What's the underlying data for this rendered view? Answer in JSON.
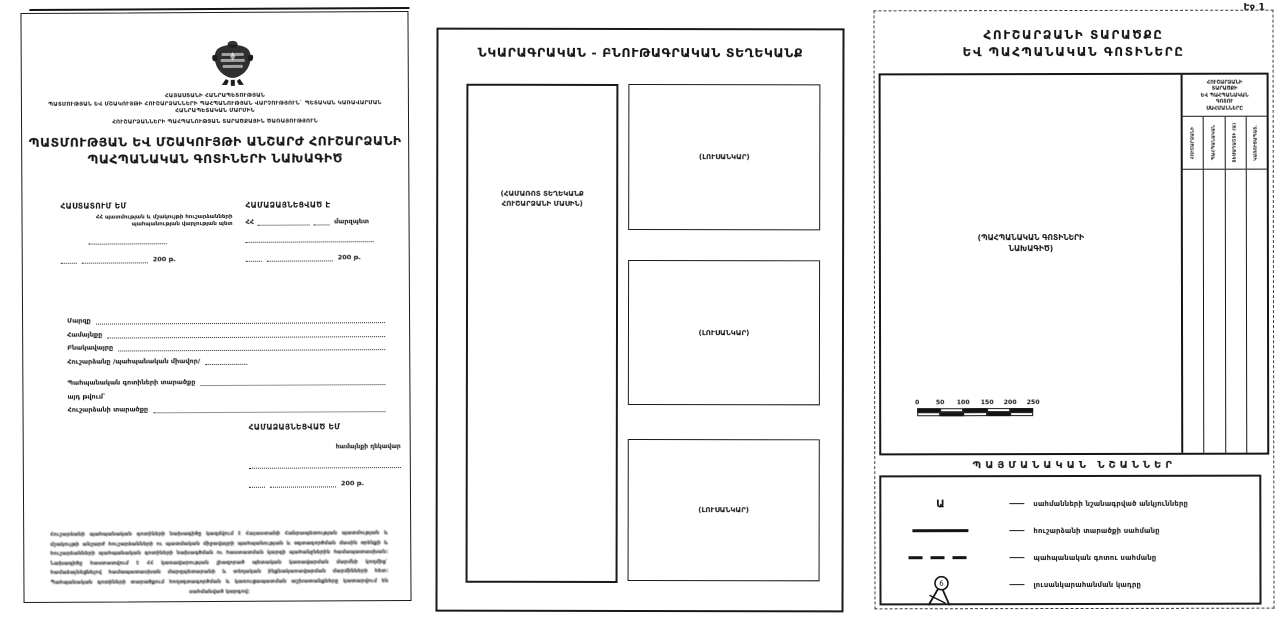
{
  "colors": {
    "ink": "#161616",
    "paper": "#ffffff"
  },
  "page_number": "Էջ 1",
  "left_page": {
    "emblem_icon": "armenia-coat-of-arms",
    "header_lines": [
      "ՀԱՅԱՍՏԱՆԻ ՀԱՆՐԱՊԵՏՈՒԹՅԱՆ",
      "ՊԱՏՄՈՒԹՅԱՆ ԵՎ ՄՇԱԿՈՒՅԹԻ ՀՈՒՇԱՐՁԱՆՆԵՐԻ ՊԱՀՊԱՆՈՒԹՅԱՆ ՎԱՐՉՈՒԹՅՈՒՆ` ՊԵՏԱԿԱՆ ԿԱՌԱՎԱՐՄԱՆ ՀԱՆՐԱՊԵՏԱԿԱՆ ՄԱՐՄԻՆ",
      "ՀՈՒՇԱՐՁԱՆՆԵՐԻ ՊԱՀՊԱՆՈՒԹՅԱՆ ՏԱՐԱԾՔԱՅԻՆ ԾԱՌԱՅՈՒԹՅՈՒՆ"
    ],
    "title_lines": [
      "ՊԱՏՄՈՒԹՅԱՆ ԵՎ ՄՇԱԿՈՒՅԹԻ ԱՆՇԱՐԺ ՀՈՒՇԱՐՁԱՆԻ",
      "ՊԱՀՊԱՆԱԿԱՆ ԳՈՏԻՆԵՐԻ ՆԱԽԱԳԻԾ"
    ],
    "approve_left": {
      "heading": "ՀԱՍՏԱՏՈՒՄ ԵՄ",
      "subtitle_lines": [
        "ՀՀ պատմության և մշակույթի հուշարձանների",
        "պահպանության վարչության պետ"
      ],
      "date_suffix": "200 թ."
    },
    "approve_right": {
      "heading": "ՀԱՄԱՁԱՅՆԵՑՎԱԾ Է",
      "prefix": "ՀՀ",
      "role": "մարզպետ",
      "date_suffix": "200 թ."
    },
    "fields": [
      {
        "label": "Մարզը"
      },
      {
        "label": "Համայնքը"
      },
      {
        "label": "Բնակավայրը"
      },
      {
        "label": "Հուշարձանը /պահպանական միավոր/"
      },
      {
        "label": "Պահպանական գոտիների տարածքը"
      },
      {
        "label": "այդ թվում`"
      },
      {
        "label": "Հուշարձանի տարածքը"
      }
    ],
    "agree_bottom": {
      "heading": "ՀԱՄԱՁԱՅՆԵՑՎԱԾ ԵՄ",
      "role": "համայնքի ղեկավար",
      "date_suffix": "200 թ."
    },
    "fine_print": "Հուշարձանի պահպանական գոտիների նախագիծը կազմվում է Հայաստանի Հանրապետության պատմության և մշակույթի անշարժ հուշարձանների ու պատմական միջավայրի պահպանության և օգտագործման մասին օրենքի և հուշարձանների պահպանական գոտիների նախագծման ու հաստատման կարգի պահանջներին համապատասխան: Նախագիծը հաստատվում է ՀՀ կառավարության լիազորած պետական կառավարման մարմնի կողմից` համաձայնեցնելով համապատասխան մարզպետարանի և տեղական ինքնակառավարման մարմինների հետ: Պահպանական գոտիների տարածքում հողօգտագործման և կառուցապատման աշխատանքները կատարվում են սահմանված կարգով:"
  },
  "middle_page": {
    "title": "ՆԿԱՐԱԳՐԱԿԱՆ - ԲՆՈՒԹԱԳՐԱԿԱՆ ՏԵՂԵԿԱՆՔ",
    "info_box_label_lines": [
      "(ՀԱՄԱՌՈՏ ՏԵՂԵԿԱՆՔ",
      "ՀՈՒՇԱՐՁԱՆԻ ՄԱՍԻՆ)"
    ],
    "photo_label": "(ԼՈՒՍԱՆԿԱՐ)"
  },
  "right_page": {
    "title_lines": [
      "ՀՈՒՇԱՐՁԱՆԻ ՏԱՐԱԾՔԸ",
      "ԵՎ ՊԱՀՊԱՆԱԿԱՆ ԳՈՏԻՆԵՐԸ"
    ],
    "plan_label_lines": [
      "(ՊԱՀՊԱՆԱԿԱՆ ԳՈՏԻՆԵՐԻ",
      "ՆԱԽԱԳԻԾ)"
    ],
    "zone_table": {
      "header_lines": [
        "ՀՈՒՇԱՐՁԱՆԻ",
        "ՏԱՐԱԾՔԻ",
        "ԵՎ ՊԱՀՊԱՆԱԿԱՆ",
        "ԳՈՏՈՒ",
        "ՍԱՀՄԱՆՆԵՐԸ"
      ],
      "columns": [
        "ՀՈՒՇԱՐՁԱՆԻ",
        "ՊԱՀՊԱՆԱԿԱՆ",
        "ՏԵՍԱԴԱՇՏԻ (Ա)",
        "ԿԱՌՈՒՑԱՊԱՏ."
      ]
    },
    "scale": {
      "ticks": [
        "0",
        "50",
        "100",
        "150",
        "200",
        "250"
      ]
    },
    "legend": {
      "title": "ՊԱՅՄԱՆԱԿԱՆ ՆՇԱՆՆԵՐ",
      "items": [
        {
          "symbol": "letter-a-marker",
          "glyph": "Ա",
          "label": "սահմանների նշանագրված անկյունները"
        },
        {
          "symbol": "solid-line",
          "label": "հուշարձանի տարածքի սահմանը"
        },
        {
          "symbol": "dashed-line",
          "label": "պահպանական գոտու սահմանը"
        },
        {
          "symbol": "camera-tripod",
          "label": "լուսանկարահանման կադրը"
        }
      ]
    }
  }
}
